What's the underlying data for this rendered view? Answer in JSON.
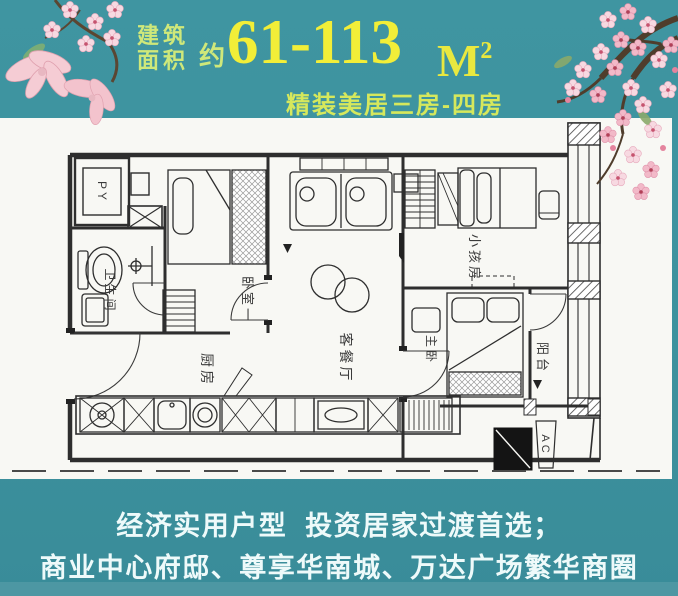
{
  "poster": {
    "header": {
      "area_label_line1": "建筑",
      "area_label_line2": "面积",
      "approx_prefix": "约",
      "area_range": "61-113",
      "area_unit": "M",
      "area_unit_exponent": "2",
      "subtitle": "精装美居三房-四房"
    },
    "floorplan": {
      "rooms": [
        {
          "id": "py-shaft",
          "label": "PY"
        },
        {
          "id": "bathroom",
          "label": "卫生间"
        },
        {
          "id": "bedroom-one",
          "label": "卧室一"
        },
        {
          "id": "kitchen",
          "label": "厨房"
        },
        {
          "id": "living-dining",
          "label": "客餐厅"
        },
        {
          "id": "kids-room",
          "label": "小孩房"
        },
        {
          "id": "master-bedroom",
          "label": "主卧"
        },
        {
          "id": "balcony",
          "label": "阳台"
        },
        {
          "id": "ac-unit",
          "label": "AC"
        }
      ]
    },
    "footer": {
      "line1": "经济实用户型  投资居家过渡首选；",
      "line2": "商业中心府邸、尊享华南城、万达广场繁华商圈"
    },
    "colors": {
      "background_teal": "#3d929e",
      "headline_yellow": "#f2ee38",
      "label_green": "#cfe87a",
      "subtitle_green": "#d6e85c",
      "footer_white": "#eefafa",
      "plan_panel_white": "#f8f8f4",
      "plan_line": "#2e2e2e",
      "blossom_pink": "#f5cdd8"
    }
  }
}
